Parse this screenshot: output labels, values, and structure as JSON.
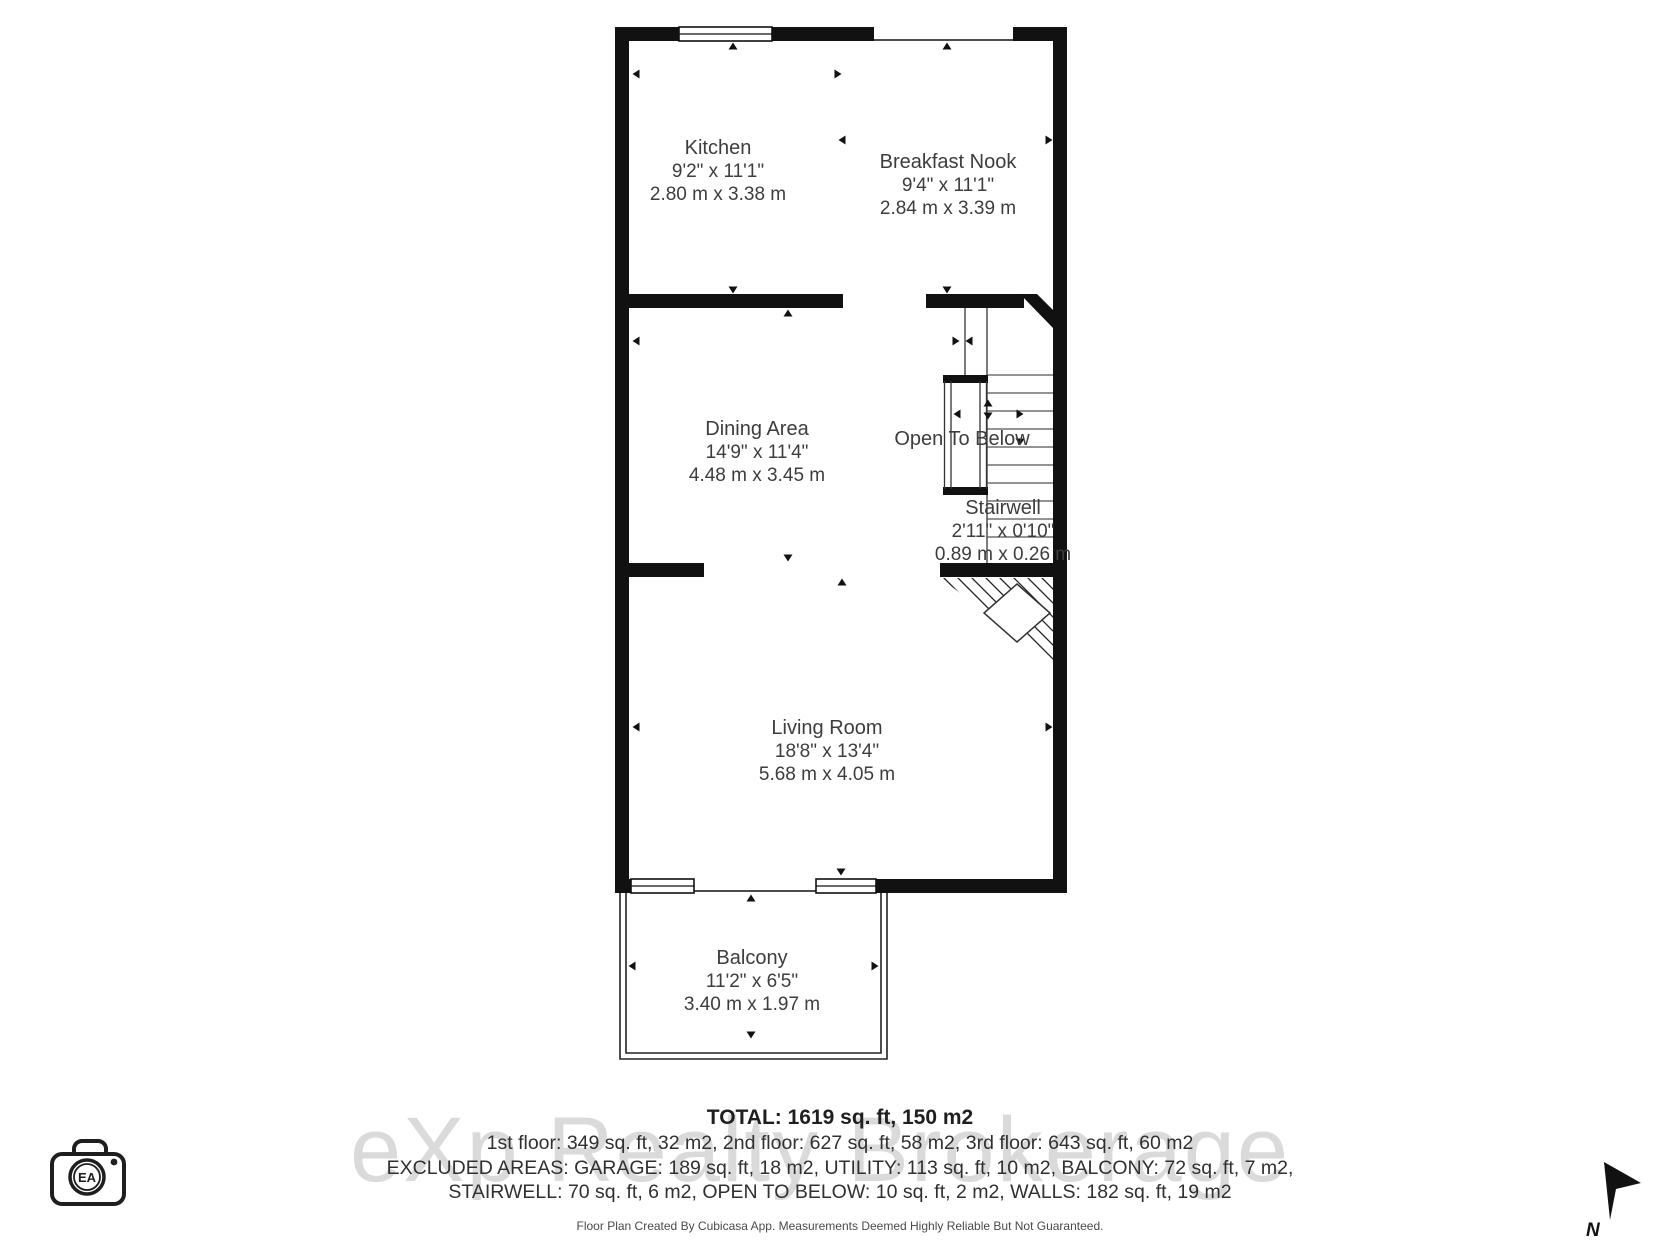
{
  "plan": {
    "rooms": [
      {
        "name": "Kitchen",
        "imperial": "9'2\" x 11'1\"",
        "metric": "2.80 m x 3.38 m"
      },
      {
        "name": "Breakfast Nook",
        "imperial": "9'4\" x 11'1\"",
        "metric": "2.84 m x 3.39 m"
      },
      {
        "name": "Dining Area",
        "imperial": "14'9\" x 11'4\"",
        "metric": "4.48 m x 3.45 m"
      },
      {
        "name": "Living Room",
        "imperial": "18'8\" x 13'4\"",
        "metric": "5.68 m x 4.05 m"
      },
      {
        "name": "Balcony",
        "imperial": "11'2\" x 6'5\"",
        "metric": "3.40 m x 1.97 m"
      },
      {
        "name": "Stairwell",
        "imperial": "2'11\" x 0'10\"",
        "metric": "0.89 m x 0.26 m"
      }
    ],
    "open_to_below_label": "Open To Below"
  },
  "summary": {
    "total": "TOTAL: 1619 sq. ft, 150 m2",
    "floors": "1st floor: 349 sq. ft, 32 m2, 2nd floor: 627 sq. ft, 58 m2, 3rd floor: 643 sq. ft, 60 m2",
    "excluded_line1": "EXCLUDED AREAS: GARAGE: 189 sq. ft, 18 m2, UTILITY: 113 sq. ft, 10 m2, BALCONY: 72 sq. ft, 7 m2,",
    "excluded_line2": "STAIRWELL: 70 sq. ft, 6 m2, OPEN TO BELOW: 10 sq. ft, 2 m2, WALLS: 182 sq. ft, 19 m2",
    "disclaimer": "Floor Plan Created By Cubicasa App. Measurements Deemed Highly Reliable But Not Guaranteed."
  },
  "watermark": {
    "text": "eXp Realty Brokerage"
  },
  "logo": {
    "initials": "EA"
  },
  "compass": {
    "label": "N"
  },
  "colors": {
    "walls": "#111111",
    "room_text": "#3d3d3d",
    "summary_text": "#303030",
    "watermark_text": "#dadada"
  }
}
